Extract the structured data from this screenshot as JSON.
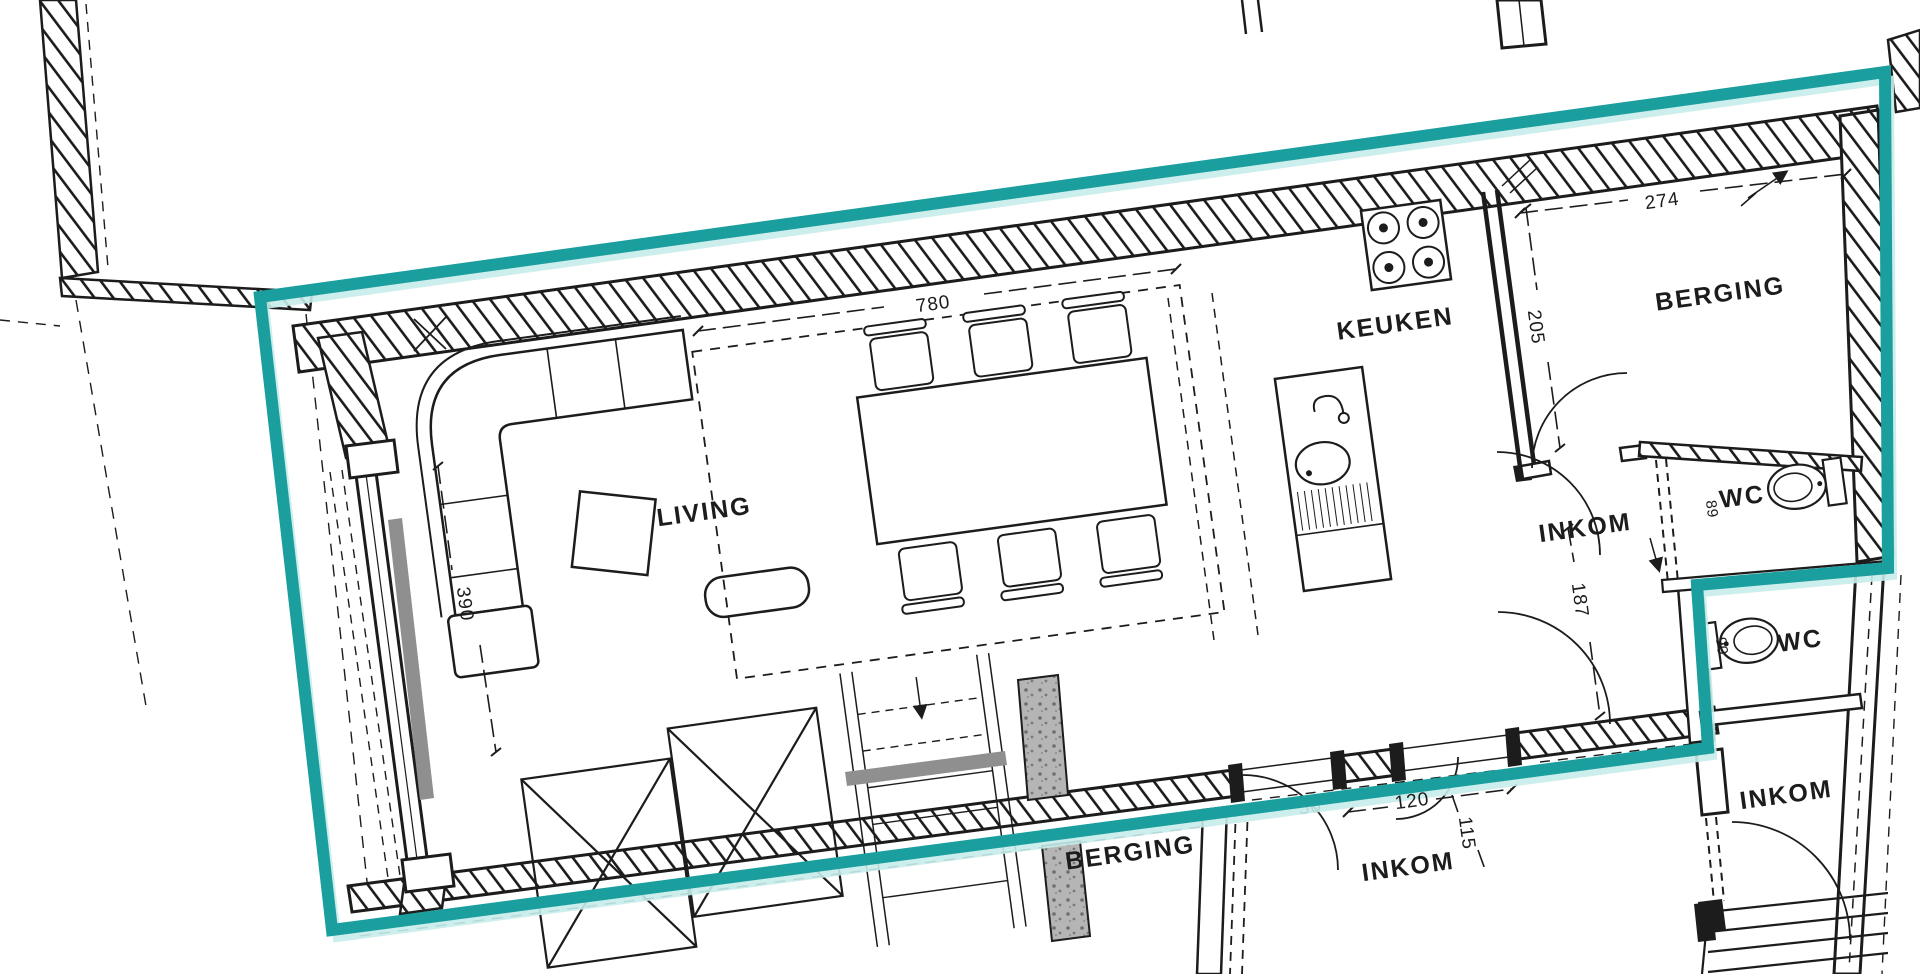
{
  "plan_type": "apartment-floor-plan",
  "rooms": {
    "living": "LIVING",
    "keuken": "KEUKEN",
    "berging_top": "BERGING",
    "inkom_mid": "INKOM",
    "wc_top": "WC",
    "wc_mid": "WC",
    "berging_bottom": "BERGING",
    "inkom_bottom": "INKOM",
    "inkom_right": "INKOM"
  },
  "dimensions": {
    "living_width": "780",
    "storage_width": "274",
    "kitchen_depth": "205",
    "window_height": "390",
    "hall_depth": "187",
    "door_width": "120",
    "entry_width": "115",
    "wc_top_depth": "89",
    "wc_mid_depth": "90",
    "pier_width": "50"
  },
  "colors": {
    "highlight": "#1b9e9e",
    "highlight_light": "#c6ecea",
    "line": "#1c1c1c",
    "concrete": "#b5b5b5",
    "panel": "#8f8f8f"
  }
}
